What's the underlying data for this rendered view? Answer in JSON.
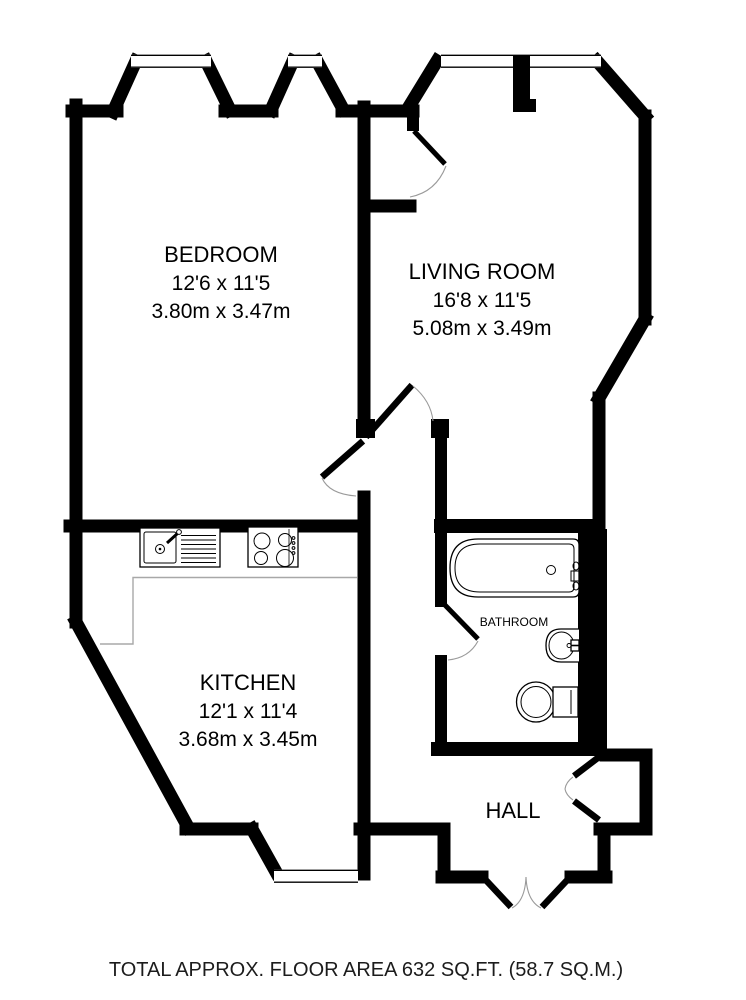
{
  "floorplan": {
    "rooms": [
      {
        "id": "bedroom",
        "name": "BEDROOM",
        "imperial": "12'6 x 11'5",
        "metric": "3.80m x 3.47m"
      },
      {
        "id": "living-room",
        "name": "LIVING ROOM",
        "imperial": "16'8 x 11'5",
        "metric": "5.08m x 3.49m"
      },
      {
        "id": "kitchen",
        "name": "KITCHEN",
        "imperial": "12'1 x 11'4",
        "metric": "3.68m x 3.45m"
      },
      {
        "id": "bathroom",
        "name": "BATHROOM"
      },
      {
        "id": "hall",
        "name": "HALL"
      }
    ],
    "fixtures": [
      "kitchen-sink-drainer",
      "four-burner-hob",
      "kitchen-counter",
      "bathtub",
      "wash-basin",
      "toilet"
    ],
    "footer": {
      "total_area_label": "TOTAL APPROX. FLOOR AREA 632 SQ.FT. (58.7 SQ.M.)"
    },
    "colors": {
      "wall": "#000000",
      "background": "#ffffff",
      "counter_line": "#a8a8a8",
      "footer_text": "#1c1c1c"
    }
  }
}
